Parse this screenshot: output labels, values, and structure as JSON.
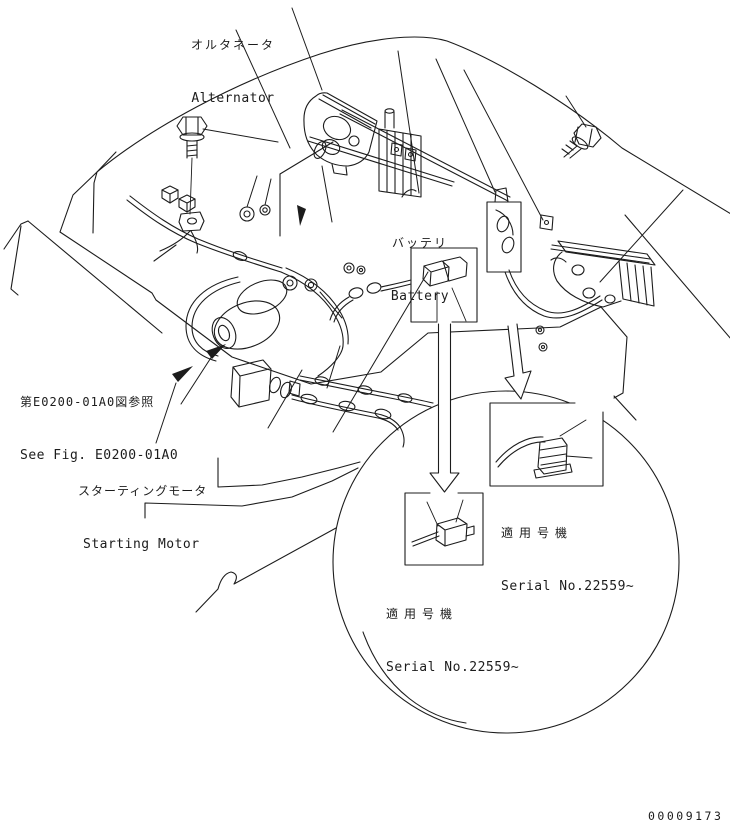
{
  "diagram": {
    "doc_number": "00009173",
    "labels": {
      "alternator": {
        "ja": "オルタネータ",
        "en": "Alternator"
      },
      "battery": {
        "ja": "バッテリ",
        "en": "Battery"
      },
      "see_fig": {
        "ja": "第E0200-01A0図参照",
        "en": "See Fig. E0200-01A0"
      },
      "starting_motor": {
        "ja": "スターティングモータ",
        "en": "Starting Motor"
      },
      "serial_right": {
        "ja": "適用号機",
        "en": "Serial No.22559~"
      },
      "serial_left": {
        "ja": "適用号機",
        "en": "Serial No.22559~"
      }
    },
    "colors": {
      "line": "#1c1c1c",
      "background": "#ffffff"
    }
  }
}
